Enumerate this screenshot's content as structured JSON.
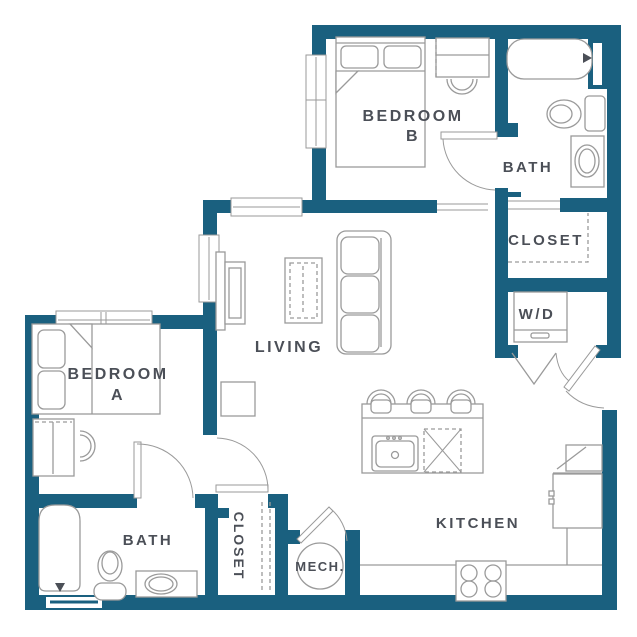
{
  "plan": {
    "rooms": {
      "bedroom_b": {
        "label": "BEDROOM",
        "label2": "B"
      },
      "bath_b": {
        "label": "BATH"
      },
      "closet_b": {
        "label": "CLOSET"
      },
      "laundry": {
        "label": "W/D"
      },
      "living": {
        "label": "LIVING"
      },
      "bedroom_a": {
        "label": "BEDROOM",
        "label2": "A"
      },
      "bath_a": {
        "label": "BATH"
      },
      "closet_a": {
        "label": "CLOSET"
      },
      "mech": {
        "label": "MECH."
      },
      "kitchen": {
        "label": "KITCHEN"
      }
    }
  },
  "colors": {
    "wall": "#1A607F",
    "furniture": "#9A9A9A",
    "label": "#4B4F57",
    "background": "#FFFFFF"
  }
}
